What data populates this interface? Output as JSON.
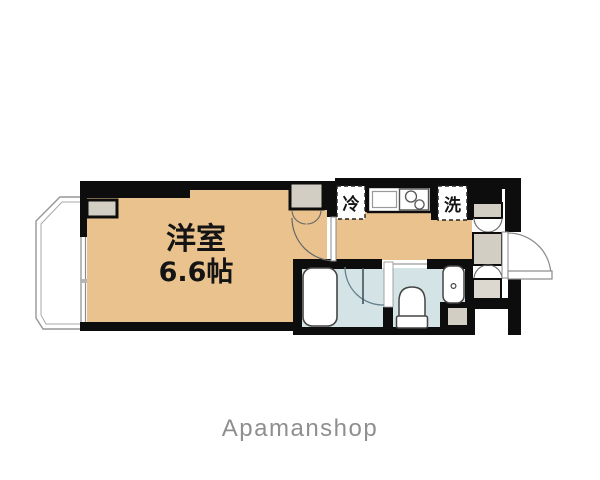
{
  "floorplan": {
    "room": {
      "label": "洋室",
      "area": "6.6帖"
    },
    "appliances": {
      "fridge_label": "冷",
      "washer_label": "洗"
    },
    "fixtures": [
      "kitchen-sink",
      "two-burner-stove",
      "bathtub",
      "toilet",
      "washbasin",
      "entrance-door",
      "room-door",
      "bathroom-door",
      "closet-double-doors",
      "hall-storage-doors",
      "balcony",
      "window"
    ],
    "brand": {
      "name": "Apamanshop"
    },
    "colors": {
      "room_floor": "#e9c28d",
      "wet_area_floor": "#d4e4e6",
      "storage_gray": "#d3cec4",
      "storage_gray_light": "#dcd8cf",
      "wall": "#0d0d0d",
      "balcony_line": "#969696",
      "brand_text": "#8f8f8f"
    }
  }
}
